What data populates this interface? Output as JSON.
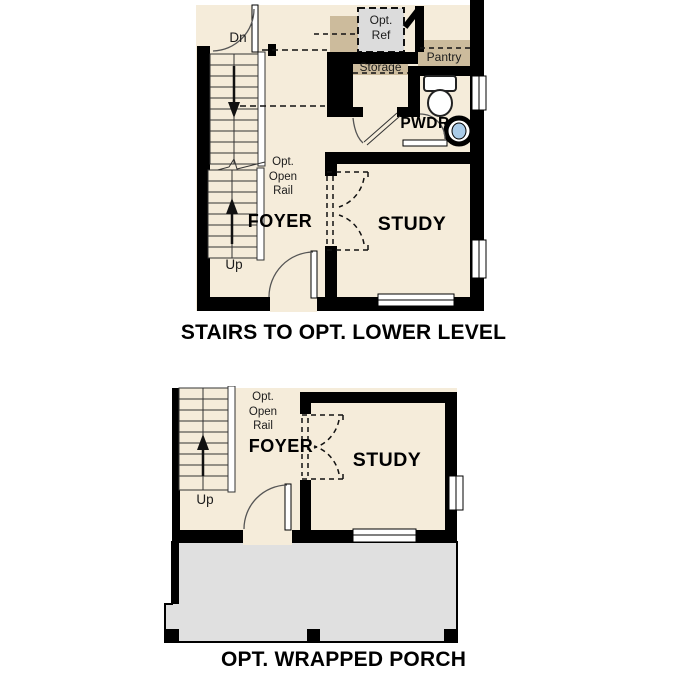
{
  "colors": {
    "floor": "#f5ecda",
    "wall": "#000000",
    "tan": "#ccbb9c",
    "ref_gray": "#dcdcdc",
    "porch": "#e0e0e0",
    "sink": "#a9cbe8",
    "line": "#333333"
  },
  "captions": {
    "upper": "STAIRS TO OPT. LOWER LEVEL",
    "lower": "OPT. WRAPPED PORCH"
  },
  "plan_upper": {
    "labels": {
      "dn": "Dn",
      "up": "Up",
      "rail1": "Opt.",
      "rail2": "Open",
      "rail3": "Rail",
      "foyer": "FOYER",
      "study": "STUDY",
      "pwdr": "PWDR",
      "storage": "Storage",
      "pantry": "Pantry",
      "ref1": "Opt.",
      "ref2": "Ref"
    }
  },
  "plan_lower": {
    "labels": {
      "up": "Up",
      "rail1": "Opt.",
      "rail2": "Open",
      "rail3": "Rail",
      "foyer": "FOYER",
      "study": "STUDY"
    }
  }
}
